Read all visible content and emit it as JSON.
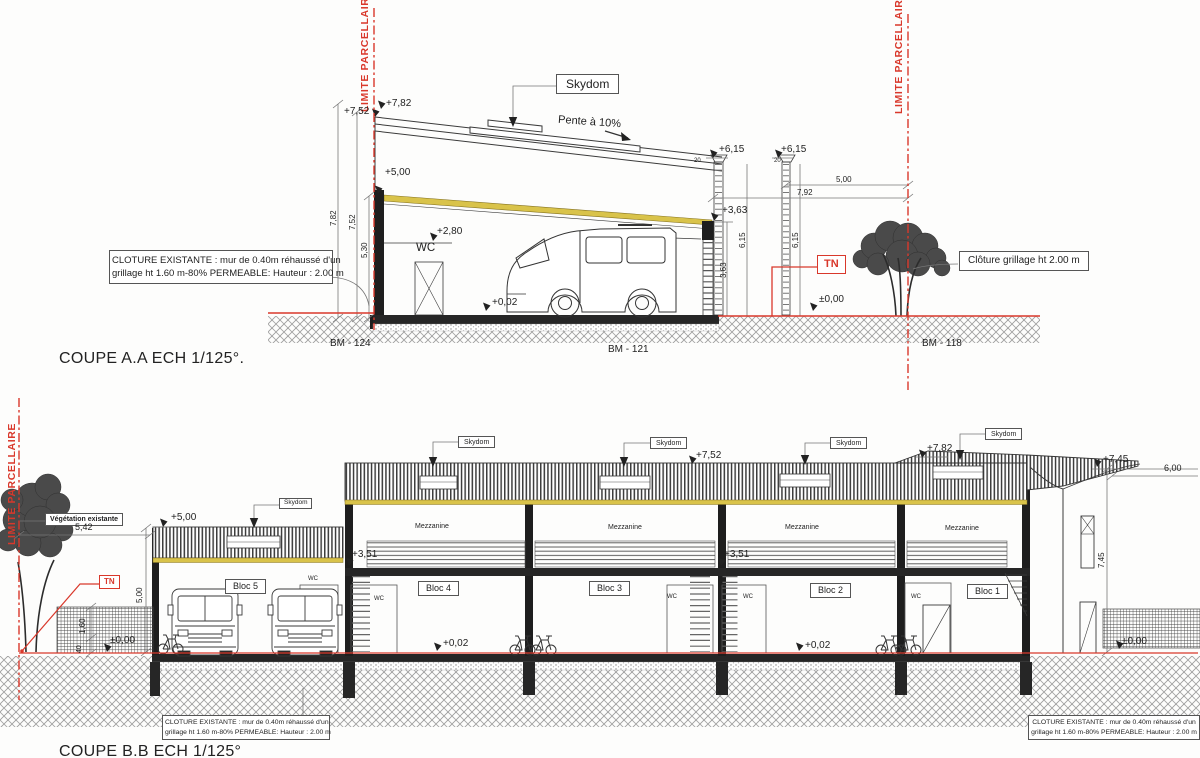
{
  "colors": {
    "red": "#d9382b",
    "yellow": "#d9c34a",
    "wall": "#1e1e1e"
  },
  "coupe_a": {
    "title": "COUPE A.A ECH 1/125°.",
    "limite_parcellaire": "LIMITE PARCELLAIRE",
    "skydom": "Skydom",
    "pente": "Pente à 10%",
    "wc": "WC",
    "tn": "TN",
    "levels": {
      "p782": "+7,82",
      "p752": "+7,52",
      "p500": "+5,00",
      "p615": "+6,15",
      "p363": "+3,63",
      "p280": "+2,80",
      "p002": "+0,02",
      "p000": "±0,00"
    },
    "dims": {
      "d782": "7,82",
      "d752": "7,52",
      "d530": "5,30",
      "d500": "5,00",
      "d792": "7,92",
      "d615": "6,15",
      "d363": "3,63",
      "d20": "20"
    },
    "bm": [
      "BM - 124",
      "BM - 121",
      "BM - 118"
    ],
    "note_cloture_1": "CLOTURE EXISTANTE : mur de 0.40m réhaussé d'un",
    "note_cloture_2": "grillage ht 1.60 m-80% PERMEABLE: Hauteur : 2.00 m",
    "note_grillage": "Clôture grillage ht 2.00 m"
  },
  "coupe_b": {
    "title": "COUPE B.B ECH 1/125°",
    "limite_parcellaire": "LIMITE PARCELLAIRE",
    "vegetation": "Végétation existante",
    "tn": "TN",
    "skydom": "Skydom",
    "mezzanine": "Mezzanine",
    "wc": "WC",
    "blocs": [
      "Bloc 5",
      "Bloc 4",
      "Bloc 3",
      "Bloc 2",
      "Bloc 1"
    ],
    "levels": {
      "p500": "+5,00",
      "p752": "+7,52",
      "p782": "+7,82",
      "p745": "+7,45",
      "p351": "+3,51",
      "p002": "+0,02",
      "p000": "±0,00"
    },
    "dims": {
      "d542": "5,42",
      "d500": "5,00",
      "d160": "1,60",
      "d40": "40",
      "d600": "6,00",
      "d745": "7,45"
    },
    "note_cloture_1": "CLOTURE EXISTANTE : mur de 0.40m réhaussé d'un",
    "note_cloture_2": "grillage ht 1.60 m-80% PERMEABLE: Hauteur : 2.00 m"
  }
}
